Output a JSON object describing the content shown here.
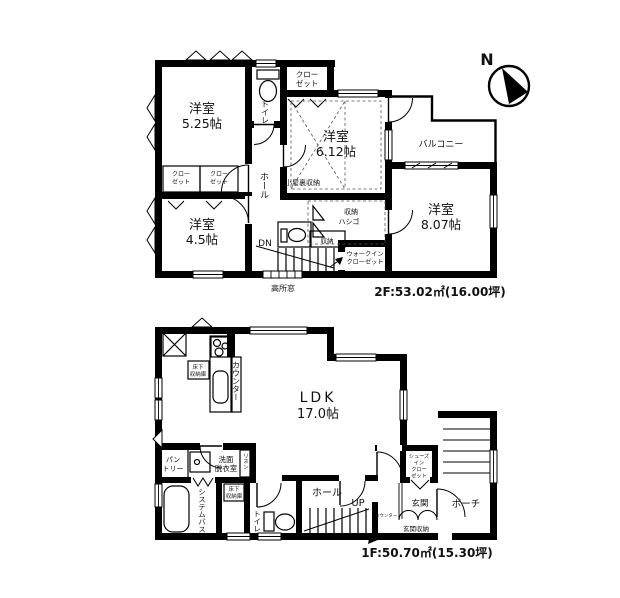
{
  "compass": {
    "north": "N"
  },
  "floor2": {
    "area": "2F:53.02㎡(16.00坪)",
    "room_525_name": "洋室",
    "room_525_size": "5.25帖",
    "room_612_name": "洋室",
    "room_612_size": "6.12帖",
    "room_807_name": "洋室",
    "room_807_size": "8.07帖",
    "room_45_name": "洋室",
    "room_45_size": "4.5帖",
    "toilet": "トイレ",
    "hall": "ホール",
    "closet_top": [
      "クロー",
      "ゼット"
    ],
    "closet_a": [
      "クロー",
      "ゼット"
    ],
    "closet_b": [
      "クロー",
      "ゼット"
    ],
    "balcony": "バルコニー",
    "attic_storage": "小屋裏収納",
    "ladder_storage": [
      "収納",
      "ハシゴ"
    ],
    "storage": "収納",
    "walk_in_closet": [
      "ウォークイン",
      "クローゼット"
    ],
    "down": "DN",
    "high_window": "高所窓"
  },
  "floor1": {
    "area": "1F:50.70㎡(15.30坪)",
    "ldk_name": "LDK",
    "ldk_size": "17.0帖",
    "counter": "カウンター",
    "kitchen_floor_storage": [
      "床下",
      "収納庫"
    ],
    "pantry": [
      "パン",
      "トリー"
    ],
    "washroom": [
      "洗面",
      "脱衣室"
    ],
    "linen": "リネン",
    "system_bath": "システムバス",
    "floor_storage": [
      "床下",
      "収納庫"
    ],
    "toilet": "トイレ",
    "hall": "ホール",
    "up": "UP",
    "shoes_in_closet": [
      "シューズ",
      "イン",
      "クロー",
      "ゼット"
    ],
    "entrance": "玄関",
    "entrance_storage": "玄関収納",
    "entrance_counter": "カウンター",
    "porch": "ポーチ"
  }
}
